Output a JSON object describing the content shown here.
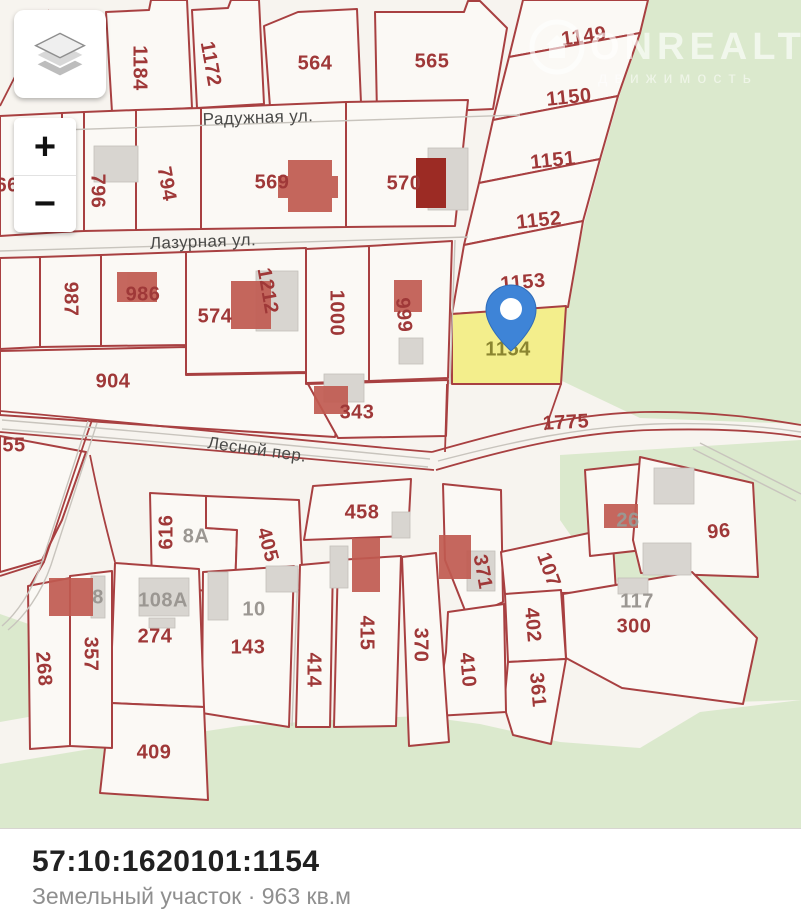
{
  "map": {
    "streets": [
      {
        "text": "Радужная ул.",
        "x": 258,
        "y": 118,
        "rot": -2
      },
      {
        "text": "Лазурная ул.",
        "x": 203,
        "y": 242,
        "rot": -2
      },
      {
        "text": "Лесной пер.",
        "x": 257,
        "y": 450,
        "rot": 8
      }
    ],
    "parcel_labels": [
      {
        "text": "1184",
        "x": 139,
        "y": 68,
        "rot": 90,
        "kind": "red"
      },
      {
        "text": "1172",
        "x": 210,
        "y": 64,
        "rot": 80,
        "kind": "red"
      },
      {
        "text": "564",
        "x": 315,
        "y": 64,
        "rot": 0,
        "kind": "red"
      },
      {
        "text": "565",
        "x": 432,
        "y": 62,
        "rot": 0,
        "kind": "red"
      },
      {
        "text": "1149",
        "x": 584,
        "y": 37,
        "rot": -8,
        "kind": "red"
      },
      {
        "text": "1150",
        "x": 569,
        "y": 98,
        "rot": -6,
        "kind": "red"
      },
      {
        "text": "1151",
        "x": 553,
        "y": 161,
        "rot": -6,
        "kind": "red"
      },
      {
        "text": "1152",
        "x": 539,
        "y": 221,
        "rot": -6,
        "kind": "red"
      },
      {
        "text": "1153",
        "x": 523,
        "y": 283,
        "rot": -5,
        "kind": "red"
      },
      {
        "text": "667",
        "x": 13,
        "y": 186,
        "rot": 0,
        "kind": "red"
      },
      {
        "text": "796",
        "x": 97,
        "y": 191,
        "rot": 90,
        "kind": "red"
      },
      {
        "text": "794",
        "x": 166,
        "y": 184,
        "rot": 80,
        "kind": "red"
      },
      {
        "text": "569",
        "x": 272,
        "y": 183,
        "rot": 0,
        "kind": "red"
      },
      {
        "text": "570",
        "x": 404,
        "y": 184,
        "rot": 0,
        "kind": "red"
      },
      {
        "text": "987",
        "x": 70,
        "y": 299,
        "rot": 90,
        "kind": "red"
      },
      {
        "text": "986",
        "x": 143,
        "y": 295,
        "rot": 0,
        "kind": "red"
      },
      {
        "text": "574",
        "x": 215,
        "y": 317,
        "rot": 0,
        "kind": "red"
      },
      {
        "text": "1212",
        "x": 267,
        "y": 291,
        "rot": 80,
        "kind": "red"
      },
      {
        "text": "1000",
        "x": 336,
        "y": 313,
        "rot": 90,
        "kind": "red"
      },
      {
        "text": "999",
        "x": 403,
        "y": 315,
        "rot": 85,
        "kind": "red"
      },
      {
        "text": "904",
        "x": 113,
        "y": 382,
        "rot": 0,
        "kind": "red"
      },
      {
        "text": "343",
        "x": 357,
        "y": 413,
        "rot": 0,
        "kind": "red"
      },
      {
        "text": "1154",
        "x": 508,
        "y": 350,
        "rot": 0,
        "kind": "olive"
      },
      {
        "text": "1775",
        "x": 566,
        "y": 423,
        "rot": -3,
        "kind": "red"
      },
      {
        "text": "55",
        "x": 14,
        "y": 446,
        "rot": 0,
        "kind": "red"
      },
      {
        "text": "616",
        "x": 167,
        "y": 532,
        "rot": -90,
        "kind": "red"
      },
      {
        "text": "8А",
        "x": 196,
        "y": 537,
        "rot": 0,
        "kind": "gray"
      },
      {
        "text": "405",
        "x": 267,
        "y": 545,
        "rot": 75,
        "kind": "red"
      },
      {
        "text": "458",
        "x": 362,
        "y": 513,
        "rot": 0,
        "kind": "red"
      },
      {
        "text": "371",
        "x": 482,
        "y": 572,
        "rot": 80,
        "kind": "red"
      },
      {
        "text": "107",
        "x": 548,
        "y": 570,
        "rot": 70,
        "kind": "red"
      },
      {
        "text": "26",
        "x": 628,
        "y": 521,
        "rot": 0,
        "kind": "gray"
      },
      {
        "text": "96",
        "x": 719,
        "y": 532,
        "rot": -5,
        "kind": "red"
      },
      {
        "text": "117",
        "x": 637,
        "y": 602,
        "rot": 0,
        "kind": "gray"
      },
      {
        "text": "300",
        "x": 634,
        "y": 627,
        "rot": 0,
        "kind": "red"
      },
      {
        "text": "8",
        "x": 98,
        "y": 598,
        "rot": 0,
        "kind": "gray"
      },
      {
        "text": "108А",
        "x": 163,
        "y": 601,
        "rot": 0,
        "kind": "gray"
      },
      {
        "text": "274",
        "x": 155,
        "y": 637,
        "rot": 0,
        "kind": "red"
      },
      {
        "text": "10",
        "x": 254,
        "y": 610,
        "rot": 0,
        "kind": "gray"
      },
      {
        "text": "143",
        "x": 248,
        "y": 648,
        "rot": 0,
        "kind": "red"
      },
      {
        "text": "414",
        "x": 313,
        "y": 670,
        "rot": 90,
        "kind": "red"
      },
      {
        "text": "415",
        "x": 366,
        "y": 633,
        "rot": 90,
        "kind": "red"
      },
      {
        "text": "370",
        "x": 420,
        "y": 645,
        "rot": 90,
        "kind": "red"
      },
      {
        "text": "410",
        "x": 467,
        "y": 670,
        "rot": 85,
        "kind": "red"
      },
      {
        "text": "402",
        "x": 532,
        "y": 625,
        "rot": 85,
        "kind": "red"
      },
      {
        "text": "361",
        "x": 537,
        "y": 690,
        "rot": 85,
        "kind": "red"
      },
      {
        "text": "268",
        "x": 43,
        "y": 669,
        "rot": 85,
        "kind": "red"
      },
      {
        "text": "357",
        "x": 90,
        "y": 654,
        "rot": 90,
        "kind": "red"
      },
      {
        "text": "409",
        "x": 154,
        "y": 753,
        "rot": 0,
        "kind": "red"
      }
    ],
    "watermark": {
      "brand": "ONREALT",
      "sub": "движимость"
    },
    "selected_parcel": {
      "number": "1154",
      "highlight_color": "#f3ee8c",
      "pin_color": "#3e84d7"
    }
  },
  "controls": {
    "zoom_in": "+",
    "zoom_out": "−"
  },
  "footer": {
    "cadastral_number": "57:10:1620101:1154",
    "description": "Земельный участок · 963 кв.м"
  },
  "colors": {
    "parcel_line": "#a84041",
    "background": "#f7f4ef",
    "green_area": "#dbe9cd",
    "label_red": "#9f3838",
    "label_gray": "#9b9792",
    "label_olive": "#8b8530"
  }
}
